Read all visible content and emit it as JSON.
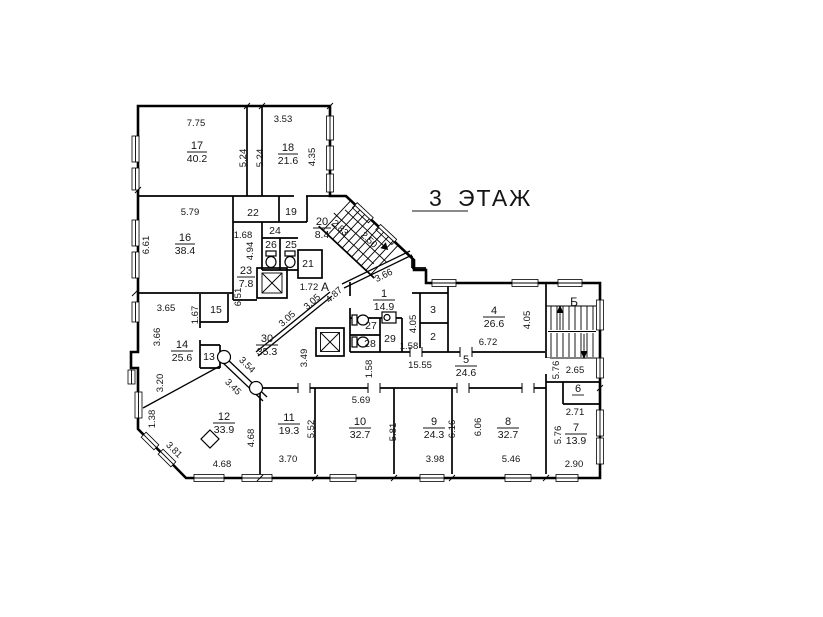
{
  "title": {
    "number": "3",
    "word": "ЭТАЖ"
  },
  "stairs": {
    "a": "А",
    "b": "Б"
  },
  "rooms": [
    {
      "num": "17",
      "area": "40.2"
    },
    {
      "num": "18",
      "area": "21.6"
    },
    {
      "num": "16",
      "area": "38.4"
    },
    {
      "num": "22"
    },
    {
      "num": "19"
    },
    {
      "num": "24"
    },
    {
      "num": "26"
    },
    {
      "num": "25"
    },
    {
      "num": "21"
    },
    {
      "num": "23",
      "area": "7.8"
    },
    {
      "num": "20",
      "area": "8.4"
    },
    {
      "num": "15"
    },
    {
      "num": "14",
      "area": "25.6"
    },
    {
      "num": "13"
    },
    {
      "num": "30",
      "area": "35.3"
    },
    {
      "num": "12",
      "area": "33.9"
    },
    {
      "num": "11",
      "area": "19.3"
    },
    {
      "num": "10",
      "area": "32.7"
    },
    {
      "num": "9",
      "area": "24.3"
    },
    {
      "num": "8",
      "area": "32.7"
    },
    {
      "num": "7",
      "area": "13.9"
    },
    {
      "num": "6"
    },
    {
      "num": "5",
      "area": "24.6"
    },
    {
      "num": "4",
      "area": "26.6"
    },
    {
      "num": "3"
    },
    {
      "num": "2"
    },
    {
      "num": "1",
      "area": "14.9"
    },
    {
      "num": "27"
    },
    {
      "num": "28"
    },
    {
      "num": "29"
    }
  ],
  "dims": [
    "7.75",
    "3.53",
    "5.24",
    "5.24",
    "4.35",
    "5.79",
    "6.61",
    "1.68",
    "4.94",
    "6.51",
    "3.65",
    "1.67",
    "3.66",
    "3.20",
    "1.38",
    "3.81",
    "4.68",
    "4.68",
    "3.70",
    "5.52",
    "5.69",
    "5.81",
    "3.98",
    "6.16",
    "6.06",
    "5.46",
    "5.76",
    "2.90",
    "2.71",
    "5.76",
    "2.65",
    "4.05",
    "4.05",
    "6.72",
    "15.55",
    "1.58",
    "1.58",
    "3.49",
    "3.54",
    "3.45",
    "2.83",
    "2.50",
    "4.87",
    "3.05",
    "3.05",
    "3.66",
    "1.72"
  ]
}
